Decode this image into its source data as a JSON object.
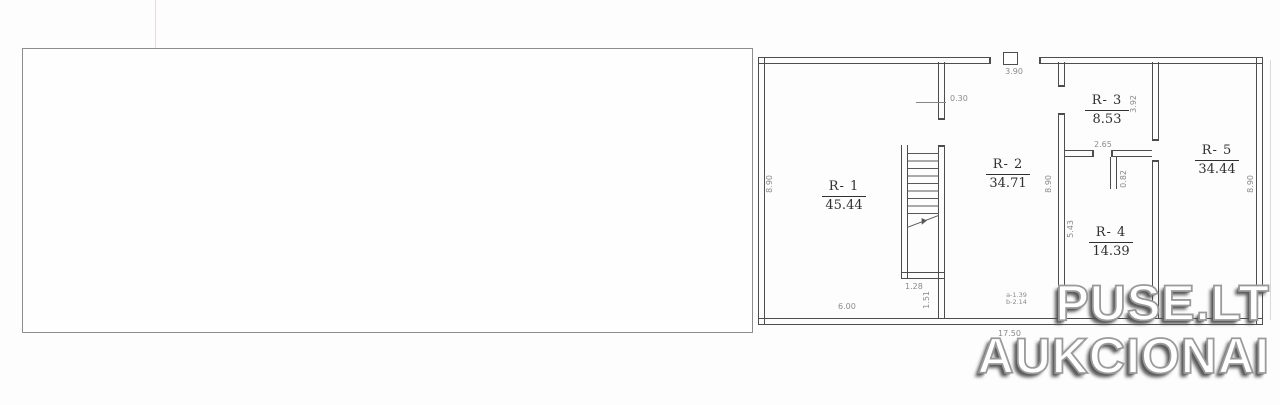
{
  "watermark": {
    "line1": "PUSE.LT",
    "line2": "AUKCIONAI"
  },
  "rooms": [
    {
      "name": "R- 1",
      "area": "45.44"
    },
    {
      "name": "R- 2",
      "area": "34.71"
    },
    {
      "name": "R- 3",
      "area": "8.53"
    },
    {
      "name": "R- 4",
      "area": "14.39"
    },
    {
      "name": "R- 5",
      "area": "34.44"
    }
  ],
  "dimensions": {
    "top_opening": "3.90",
    "wall_offset": "0.30",
    "left_height": "8.90",
    "mid_height": "8.90",
    "right_height": "8.90",
    "r3_height": "3.92",
    "r3_width": "2.65",
    "r4_door": "0.82",
    "r4_height": "5.43",
    "stair_width": "1.28",
    "stair_depth": "1.51",
    "r1_width": "6.00",
    "r2_door_a": "a-1.39",
    "r2_door_b": "b-2.14",
    "total_width": "17.50"
  },
  "colors": {
    "wall_line": "#4d4d4d",
    "dimension_text": "#8a8a8a",
    "sheet_frame": "#8d8d8d",
    "watermark_fill": "#ffffff",
    "watermark_outline": "#9a9a9a",
    "watermark_shadow": "#505050"
  }
}
